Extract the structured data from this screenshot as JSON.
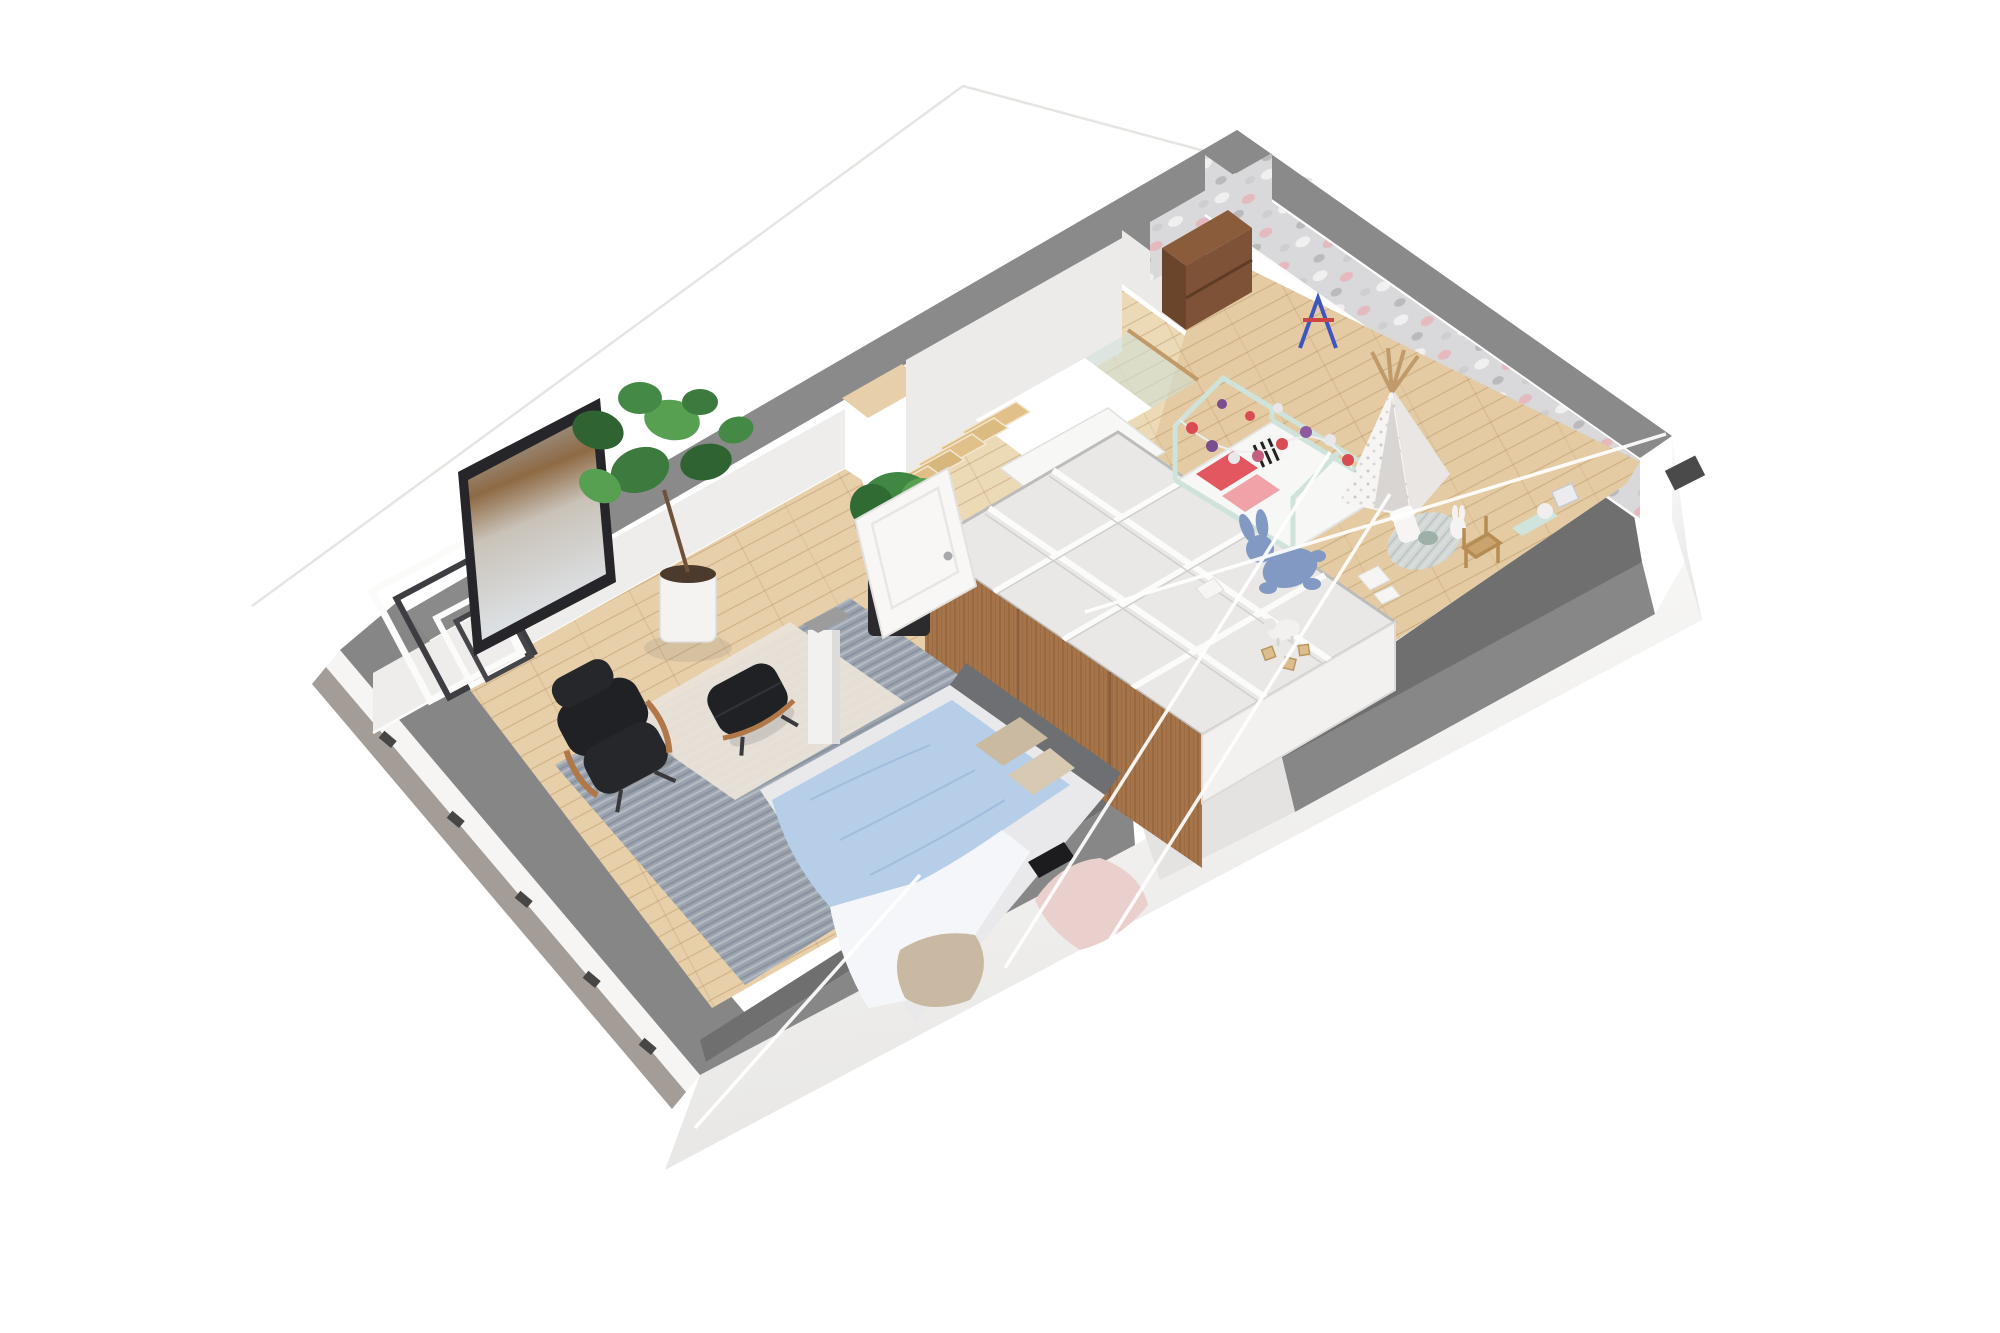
{
  "title": "3D attic floor plan render (top-down axonometric)",
  "scene": {
    "type": "architectural-3d-floor-plan",
    "rooms": [
      {
        "id": "bedroom",
        "label": "Bedroom",
        "items": [
          "double bed with blue duvet and pink blanket",
          "gray area rug",
          "beige overlay rug",
          "lounge chair",
          "ottoman",
          "white column",
          "abstract painting",
          "decorative ladder frames",
          "fiddle leaf fig plant",
          "boxwood plant in black pot",
          "white panel door",
          "wall TV"
        ]
      },
      {
        "id": "landing",
        "label": "Stair landing",
        "items": [
          "staircase",
          "stairwell opening",
          "glass balustrade with wooden handrail",
          "white cabinet",
          "built-in wardrobe with walnut fronts"
        ]
      },
      {
        "id": "kids-room",
        "label": "Kids room",
        "items": [
          "house-frame bed with pompom garland",
          "teepee play tent",
          "bookshelf with books",
          "easel",
          "plush bunny",
          "toy lamb",
          "wooden blocks",
          "round play rug with toys",
          "small wooden chair",
          "wall shelf with lamp"
        ]
      }
    ]
  },
  "palette": {
    "background": "#ffffff",
    "wall_top": "#8a8a8a",
    "wall_shadow": "#6f6f6f",
    "wall_face": "#efedeb",
    "wallpaper": "#d9d8da",
    "floor": "#e7cfa9",
    "floor_kids": "#e4cba3",
    "floor_landing": "#ecd9b6",
    "fascia": "#f4f3f2",
    "eave": "#a49d97",
    "rug": "#9aa3ae",
    "rug_overlay": "#eae3d9",
    "wood_front": "#a5744a",
    "stair_wood": "#e2c089",
    "mint": "#cfe3da",
    "duvet": "#b6cee8",
    "blush": "#ead0cd",
    "leather": "#202124",
    "glass": "#cfe0d7",
    "roofline": "#ffffff",
    "garland_red": "#d94b52",
    "garland_purple": "#7a4e8f",
    "easel_blue": "#3d56c0",
    "easel_red": "#cc4444",
    "bunny_blue": "#8299c4"
  }
}
